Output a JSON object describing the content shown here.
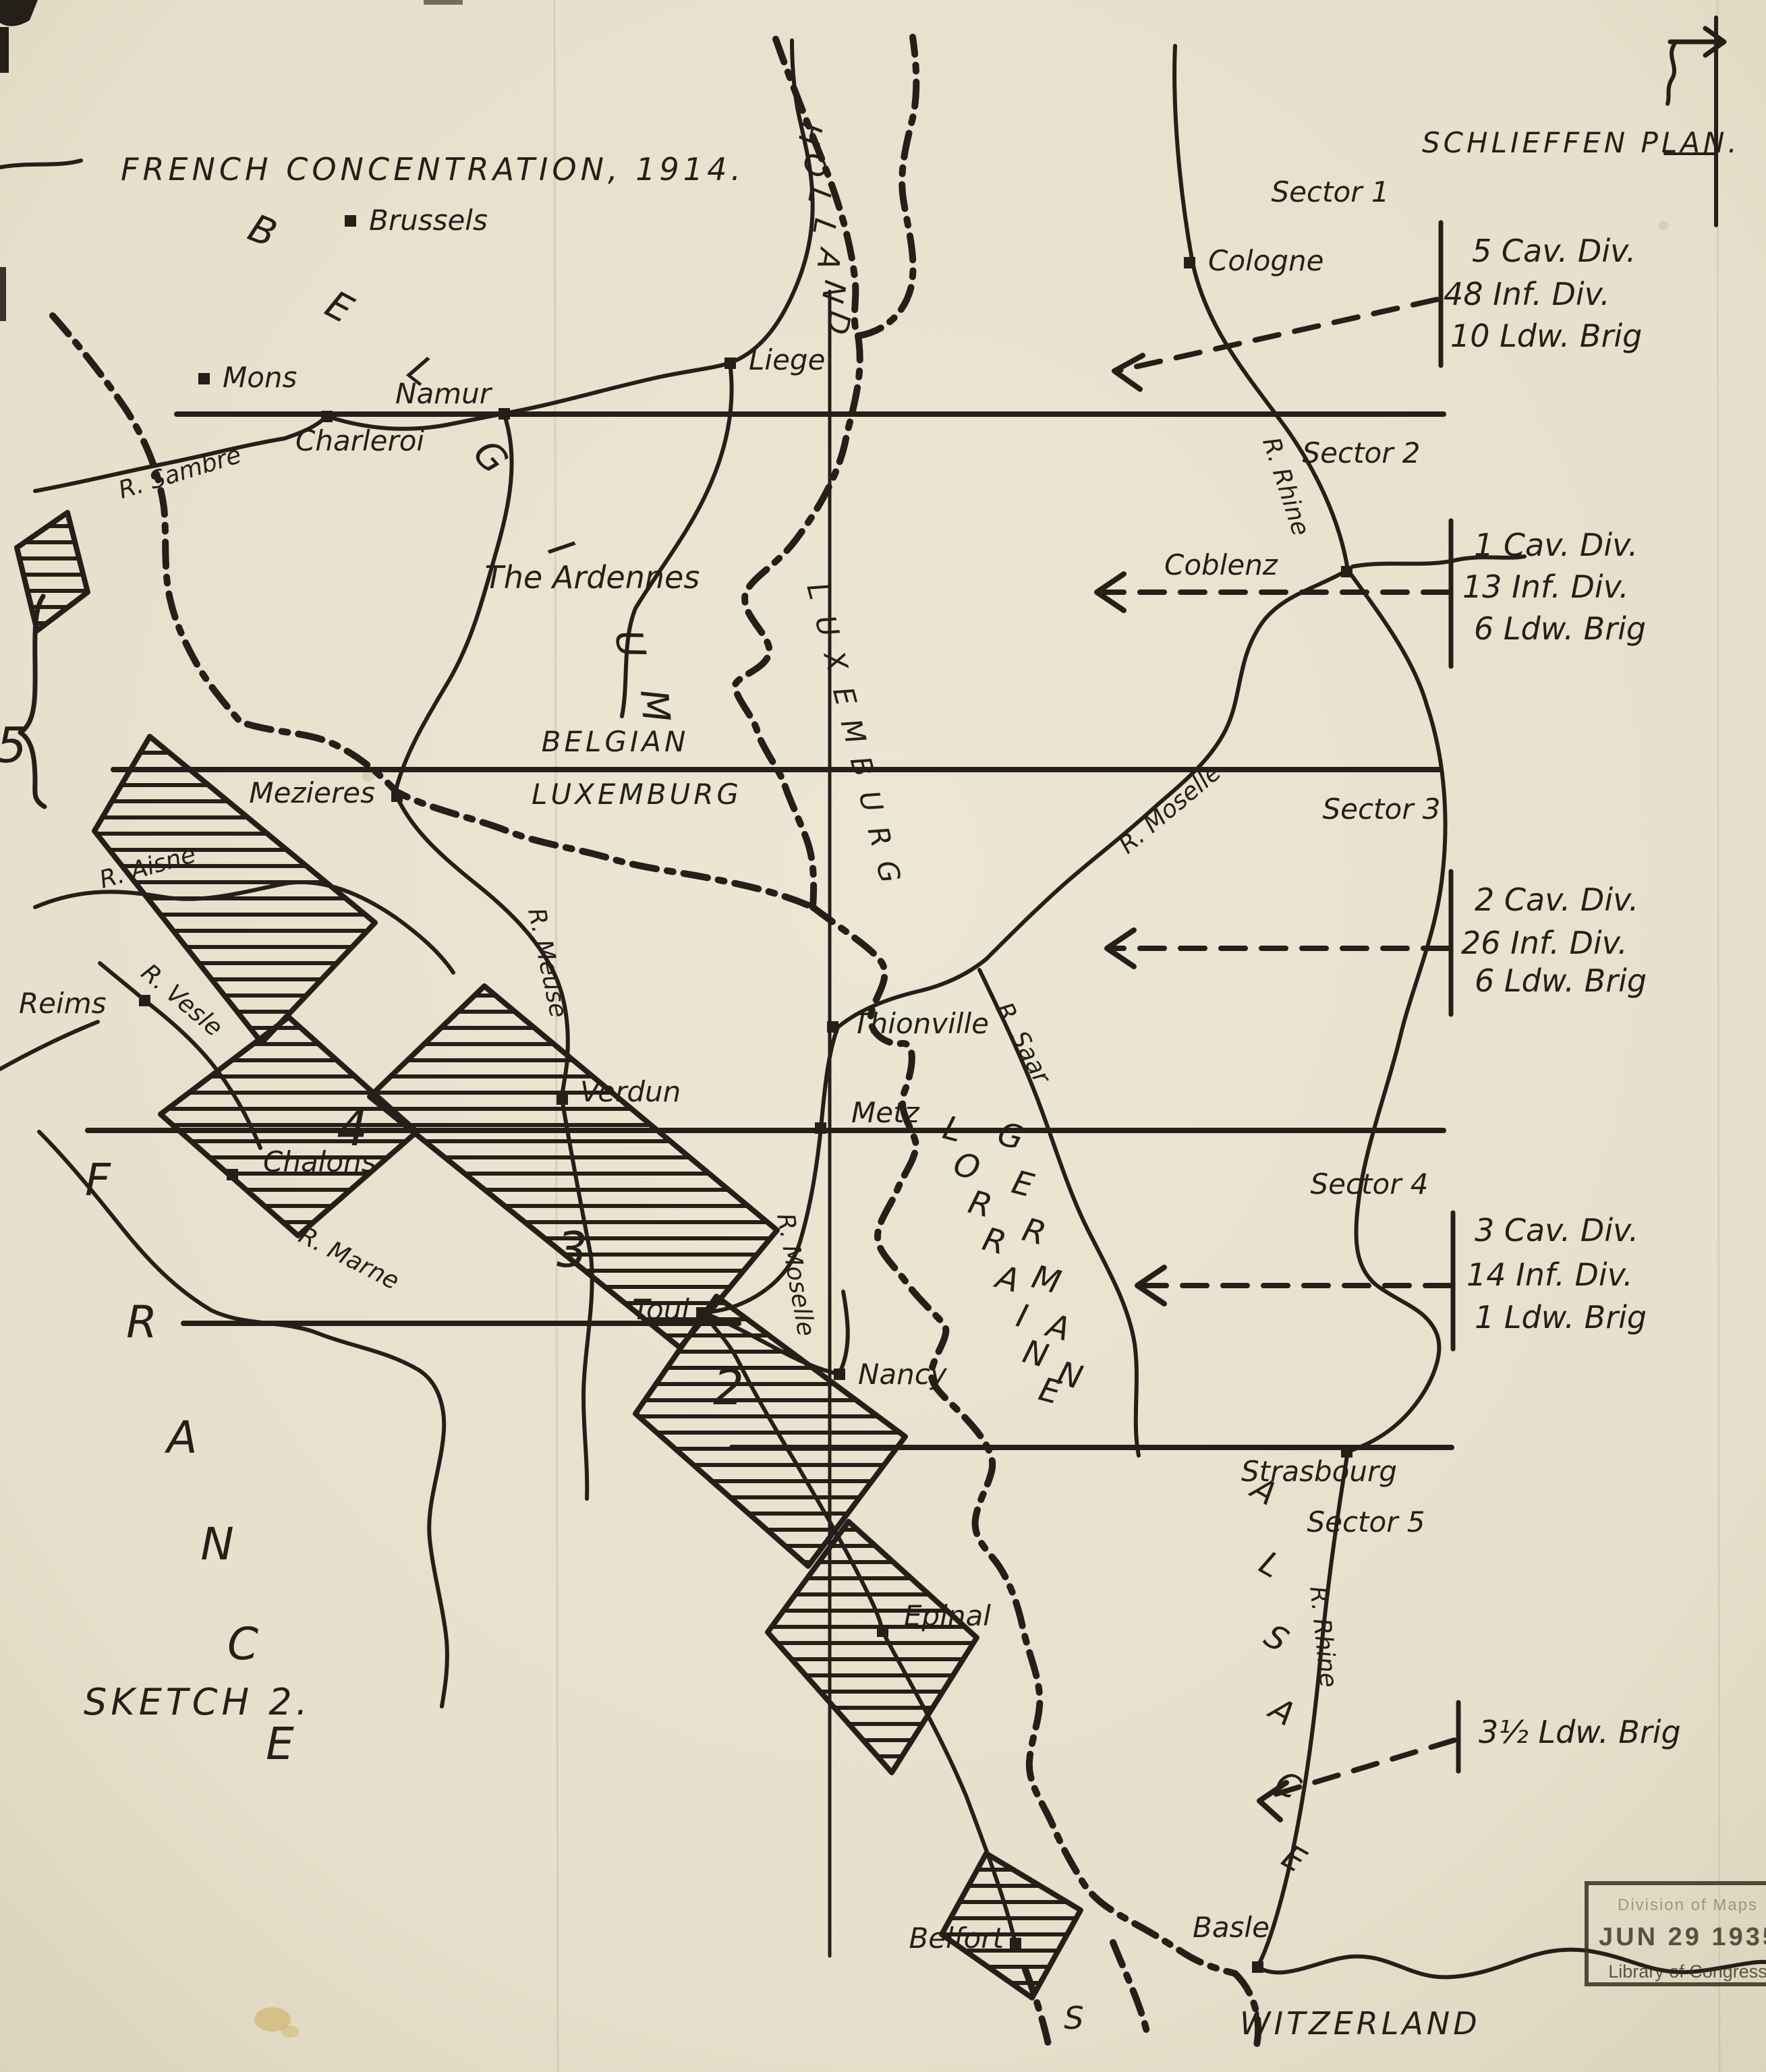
{
  "colors": {
    "ink": "#241f18",
    "paper": "#e7e0cc"
  },
  "titles": {
    "main": "FRENCH CONCENTRATION, 1914.",
    "right": "SCHLIEFFEN PLAN.",
    "sketch": "SKETCH 2."
  },
  "sectors": [
    {
      "label": "Sector 1",
      "units": [
        "5 Cav. Div.",
        "48 Inf. Div.",
        "10 Ldw. Brig"
      ]
    },
    {
      "label": "Sector 2",
      "units": [
        "1 Cav. Div.",
        "13 Inf. Div.",
        "6 Ldw. Brig"
      ]
    },
    {
      "label": "Sector 3",
      "units": [
        "2 Cav. Div.",
        "26 Inf. Div.",
        "6 Ldw. Brig"
      ]
    },
    {
      "label": "Sector 4",
      "units": [
        "3 Cav. Div.",
        "14 Inf. Div.",
        "1 Ldw. Brig"
      ]
    },
    {
      "label": "Sector 5",
      "units": [
        "3½ Ldw. Brig"
      ]
    }
  ],
  "armies": [
    {
      "number": "5"
    },
    {
      "number": "4"
    },
    {
      "number": "3"
    },
    {
      "number": "2"
    }
  ],
  "cities": [
    {
      "name": "Brussels"
    },
    {
      "name": "Mons"
    },
    {
      "name": "Namur"
    },
    {
      "name": "Charleroi"
    },
    {
      "name": "Liege"
    },
    {
      "name": "Cologne"
    },
    {
      "name": "Coblenz"
    },
    {
      "name": "Mezieres"
    },
    {
      "name": "Reims"
    },
    {
      "name": "Chalons"
    },
    {
      "name": "Verdun"
    },
    {
      "name": "Thionville"
    },
    {
      "name": "Metz"
    },
    {
      "name": "Toul"
    },
    {
      "name": "Nancy"
    },
    {
      "name": "Strasbourg"
    },
    {
      "name": "Epinal"
    },
    {
      "name": "Belfort"
    },
    {
      "name": "Basle"
    }
  ],
  "rivers": [
    {
      "name": "R. Sambre"
    },
    {
      "name": "R. Aisne"
    },
    {
      "name": "R. Vesle"
    },
    {
      "name": "R. Marne"
    },
    {
      "name": "R. Meuse"
    },
    {
      "name": "R. Moselle"
    },
    {
      "name": "R. Moselle"
    },
    {
      "name": "R. Rhine"
    },
    {
      "name": "R. Rhine"
    },
    {
      "name": "R. Saar"
    }
  ],
  "regions": {
    "belgium": "BELGIUM",
    "holland": "HOLLAND",
    "ardennes": "The Ardennes",
    "belgian_lux_line1": "BELGIAN",
    "belgian_lux_line2": "LUXEMBURG",
    "luxemburg_country": "LUXEMBURG",
    "german": "GERMAN",
    "lorraine": "LORRAINE",
    "alsace": "ALSACE",
    "france": "FRANCE",
    "switzerland_part1": "S",
    "switzerland_part2": "WITZERLAND"
  },
  "stamp": {
    "line1": "Division of Maps",
    "date": "JUN 29 1935",
    "org": "Library of Congress"
  }
}
